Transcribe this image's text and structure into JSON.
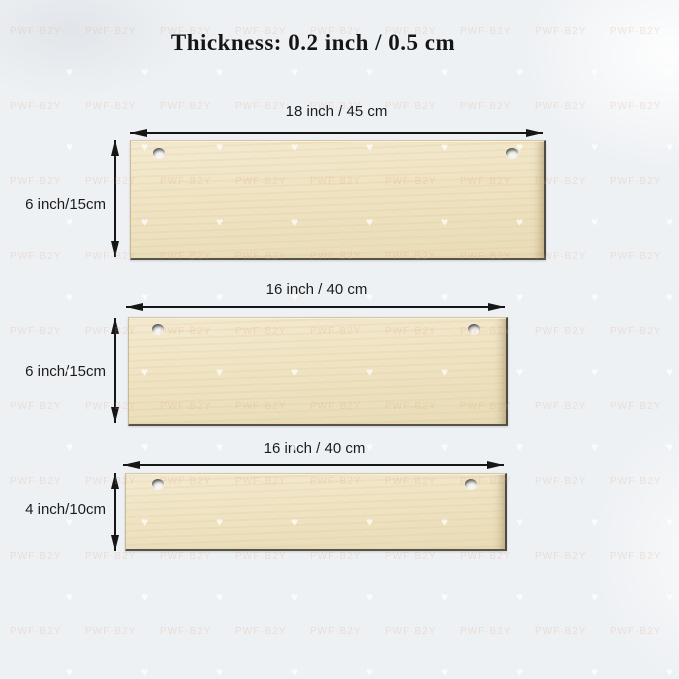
{
  "title": "Thickness: 0.2 inch / 0.5 cm",
  "watermark": {
    "brand_text": "PWF·B2Y",
    "heart_glyph": "♥"
  },
  "colors": {
    "background": "#eef1f4",
    "board": "#efe3c2",
    "ink": "#161616",
    "label": "#1c1c1c"
  },
  "boards": [
    {
      "id": "18x6",
      "width_label": "18 inch  /  45 cm",
      "height_label": "6 inch/15cm"
    },
    {
      "id": "16x6",
      "width_label": "16 inch  /  40 cm",
      "height_label": "6 inch/15cm"
    },
    {
      "id": "16x4",
      "width_label": "16 inch  /  40 cm",
      "height_label": "4 inch/10cm"
    }
  ]
}
